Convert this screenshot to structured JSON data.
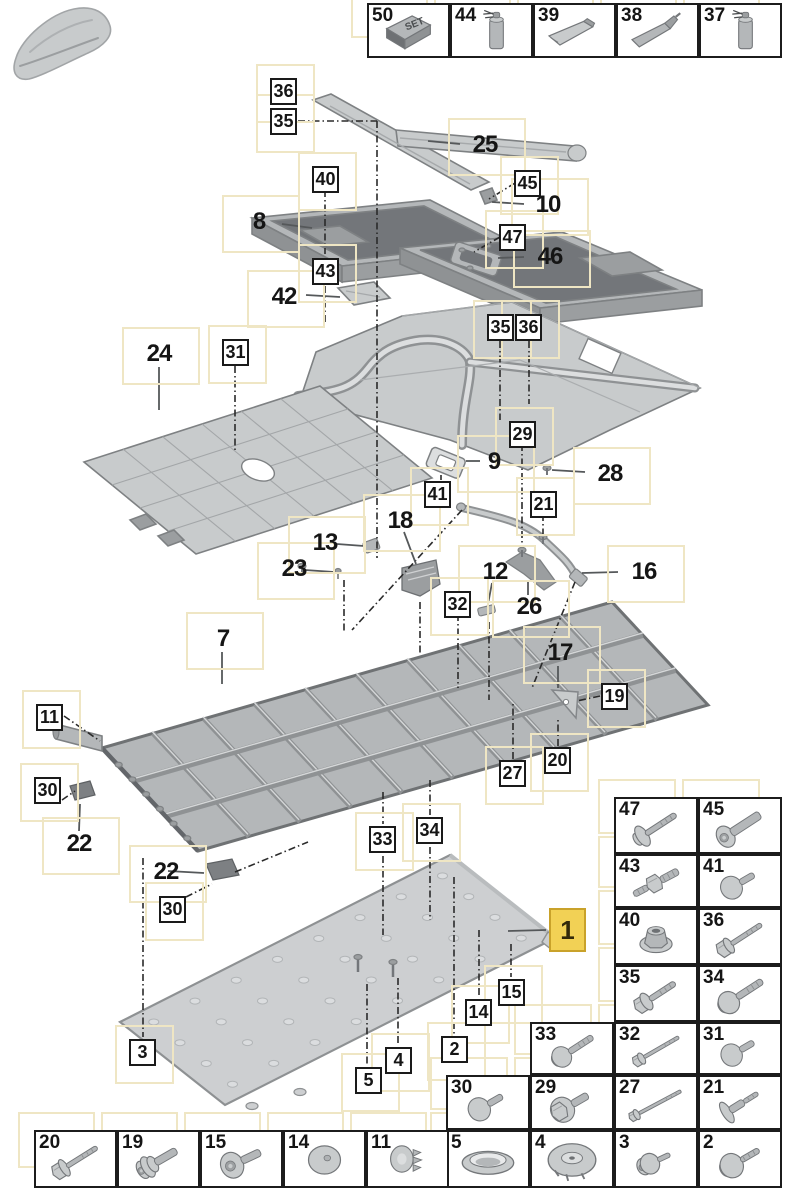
{
  "colors": {
    "highlight_fill": "#f2d155",
    "highlight_border": "#c9a22a",
    "halo": "#efe6c4",
    "box_border": "#1a1a1a",
    "part_gray": "#c8cbcc",
    "part_dark": "#8f9294",
    "line": "#2a2a2a"
  },
  "car_thumbnail": {
    "name": "car-silhouette"
  },
  "top_strip": {
    "x": 367,
    "y": 3,
    "cell_w": 83,
    "cell_h": 55,
    "cells": [
      {
        "num": "50",
        "icon": "set-box",
        "label": "SET"
      },
      {
        "num": "44",
        "icon": "spray-can",
        "label": ""
      },
      {
        "num": "39",
        "icon": "tube",
        "label": ""
      },
      {
        "num": "38",
        "icon": "cartridge",
        "label": ""
      },
      {
        "num": "37",
        "icon": "spray-can",
        "label": ""
      }
    ]
  },
  "callouts": [
    {
      "num": "36",
      "style": "boxed",
      "x": 270,
      "y": 78
    },
    {
      "num": "35",
      "style": "boxed",
      "x": 270,
      "y": 108
    },
    {
      "num": "40",
      "style": "boxed",
      "x": 312,
      "y": 166
    },
    {
      "num": "45",
      "style": "boxed",
      "x": 514,
      "y": 170
    },
    {
      "num": "47",
      "style": "boxed",
      "x": 499,
      "y": 224
    },
    {
      "num": "43",
      "style": "boxed",
      "x": 312,
      "y": 258
    },
    {
      "num": "31",
      "style": "boxed",
      "x": 222,
      "y": 339
    },
    {
      "num": "35",
      "style": "boxed",
      "x": 487,
      "y": 314
    },
    {
      "num": "36",
      "style": "boxed",
      "x": 515,
      "y": 314
    },
    {
      "num": "29",
      "style": "boxed",
      "x": 509,
      "y": 421
    },
    {
      "num": "41",
      "style": "boxed",
      "x": 424,
      "y": 481
    },
    {
      "num": "21",
      "style": "boxed",
      "x": 530,
      "y": 491
    },
    {
      "num": "32",
      "style": "boxed",
      "x": 444,
      "y": 591
    },
    {
      "num": "11",
      "style": "boxed",
      "x": 36,
      "y": 704
    },
    {
      "num": "30",
      "style": "boxed",
      "x": 34,
      "y": 777
    },
    {
      "num": "30",
      "style": "boxed",
      "x": 159,
      "y": 896
    },
    {
      "num": "19",
      "style": "boxed",
      "x": 601,
      "y": 683
    },
    {
      "num": "20",
      "style": "boxed",
      "x": 544,
      "y": 747
    },
    {
      "num": "27",
      "style": "boxed",
      "x": 499,
      "y": 760
    },
    {
      "num": "33",
      "style": "boxed",
      "x": 369,
      "y": 826
    },
    {
      "num": "34",
      "style": "boxed",
      "x": 416,
      "y": 817
    },
    {
      "num": "15",
      "style": "boxed",
      "x": 498,
      "y": 979
    },
    {
      "num": "14",
      "style": "boxed",
      "x": 465,
      "y": 999
    },
    {
      "num": "2",
      "style": "boxed",
      "x": 441,
      "y": 1036
    },
    {
      "num": "3",
      "style": "boxed",
      "x": 129,
      "y": 1039
    },
    {
      "num": "4",
      "style": "boxed",
      "x": 385,
      "y": 1047
    },
    {
      "num": "5",
      "style": "boxed",
      "x": 355,
      "y": 1067
    },
    {
      "num": "25",
      "style": "plain",
      "x": 462,
      "y": 132
    },
    {
      "num": "10",
      "style": "plain",
      "x": 525,
      "y": 192
    },
    {
      "num": "8",
      "style": "plain",
      "x": 236,
      "y": 209
    },
    {
      "num": "46",
      "style": "plain",
      "x": 527,
      "y": 244
    },
    {
      "num": "42",
      "style": "plain",
      "x": 261,
      "y": 284
    },
    {
      "num": "24",
      "style": "plain",
      "x": 136,
      "y": 341
    },
    {
      "num": "9",
      "style": "plain",
      "x": 471,
      "y": 449
    },
    {
      "num": "28",
      "style": "plain",
      "x": 587,
      "y": 461
    },
    {
      "num": "18",
      "style": "plain",
      "x": 377,
      "y": 508
    },
    {
      "num": "13",
      "style": "plain",
      "x": 302,
      "y": 530
    },
    {
      "num": "23",
      "style": "plain",
      "x": 271,
      "y": 556
    },
    {
      "num": "12",
      "style": "plain",
      "x": 472,
      "y": 559
    },
    {
      "num": "26",
      "style": "plain",
      "x": 506,
      "y": 594
    },
    {
      "num": "16",
      "style": "plain",
      "x": 621,
      "y": 559
    },
    {
      "num": "7",
      "style": "plain",
      "x": 200,
      "y": 626
    },
    {
      "num": "17",
      "style": "plain",
      "x": 537,
      "y": 640
    },
    {
      "num": "22",
      "style": "plain",
      "x": 56,
      "y": 831
    },
    {
      "num": "22",
      "style": "plain",
      "x": 143,
      "y": 859
    },
    {
      "num": "1",
      "style": "highlight",
      "x": 549,
      "y": 908
    }
  ],
  "fastener_table": {
    "columns": [
      446,
      530,
      614,
      698
    ],
    "col_w": 84,
    "rows": [
      {
        "y": 797,
        "h": 57,
        "cells": [
          {
            "col": 2,
            "num": "47",
            "icon": "screw-long"
          },
          {
            "col": 3,
            "num": "45",
            "icon": "bolt-pan"
          }
        ]
      },
      {
        "y": 854,
        "h": 54,
        "cells": [
          {
            "col": 2,
            "num": "43",
            "icon": "stud-hex"
          },
          {
            "col": 3,
            "num": "41",
            "icon": "washer-dome"
          }
        ]
      },
      {
        "y": 908,
        "h": 57,
        "cells": [
          {
            "col": 2,
            "num": "40",
            "icon": "nut-flange"
          },
          {
            "col": 3,
            "num": "36",
            "icon": "hex-bolt-long"
          }
        ]
      },
      {
        "y": 965,
        "h": 57,
        "cells": [
          {
            "col": 2,
            "num": "35",
            "icon": "hex-washer-bolt"
          },
          {
            "col": 3,
            "num": "34",
            "icon": "washer-bolt-long"
          }
        ]
      },
      {
        "y": 1022,
        "h": 53,
        "cells": [
          {
            "col": 1,
            "num": "33",
            "icon": "washer-bolt-long"
          },
          {
            "col": 2,
            "num": "32",
            "icon": "thin-bolt-long"
          },
          {
            "col": 3,
            "num": "31",
            "icon": "washer-dome"
          }
        ]
      },
      {
        "y": 1075,
        "h": 55,
        "cells": [
          {
            "col": 0,
            "num": "30",
            "icon": "washer-dome"
          },
          {
            "col": 1,
            "num": "29",
            "icon": "hex-washer-big"
          },
          {
            "col": 2,
            "num": "27",
            "icon": "thin-bolt-xl"
          },
          {
            "col": 3,
            "num": "21",
            "icon": "step-washer-bolt"
          }
        ]
      },
      {
        "y": 1130,
        "h": 58,
        "cells": [
          {
            "col": 0,
            "num": "5",
            "icon": "grommet-oval"
          },
          {
            "col": 1,
            "num": "4",
            "icon": "round-cover"
          },
          {
            "col": 2,
            "num": "3",
            "icon": "pan-washer-screw"
          },
          {
            "col": 3,
            "num": "2",
            "icon": "pan-big-washer"
          }
        ]
      }
    ]
  },
  "bottom_strip": {
    "x0": 34,
    "y": 1130,
    "cell_w": 83,
    "cell_h": 58,
    "cells": [
      {
        "num": "20",
        "icon": "hex-flange-bolt"
      },
      {
        "num": "19",
        "icon": "collar-screw"
      },
      {
        "num": "15",
        "icon": "pan-torx"
      },
      {
        "num": "14",
        "icon": "dome-cap"
      },
      {
        "num": "11",
        "icon": "fir-clip"
      }
    ]
  }
}
